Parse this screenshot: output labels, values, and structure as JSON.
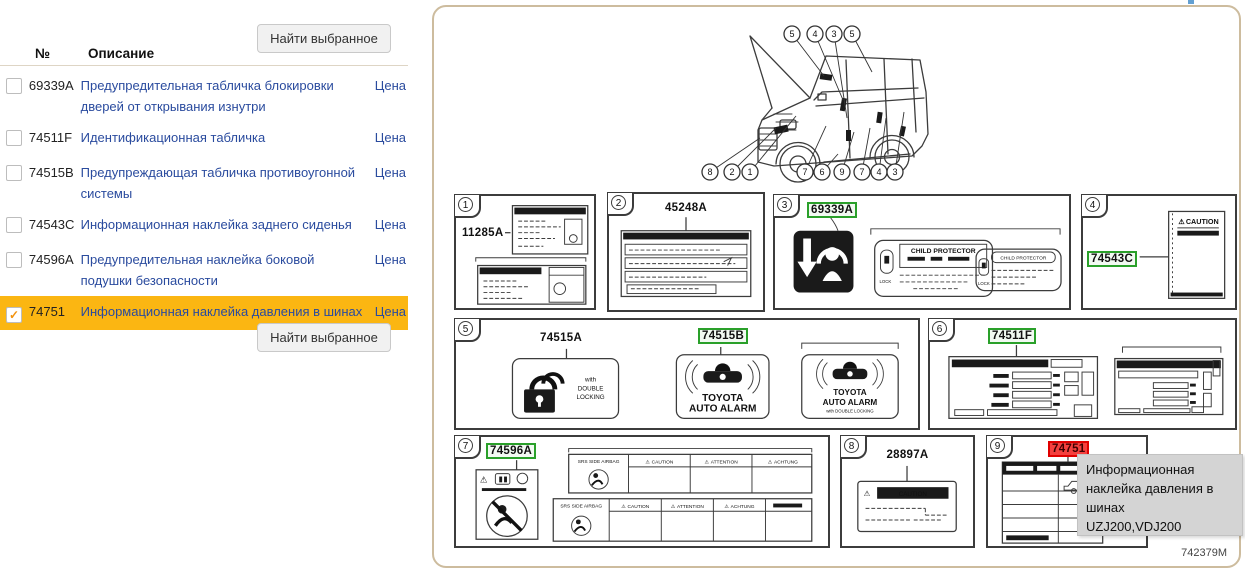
{
  "icons": {
    "check": "✓",
    "warning": "⚠"
  },
  "colors": {
    "highlight_row": "#FBB612",
    "link": "#2A4B9E",
    "panel_border": "#CDBC9E",
    "green_part": "#2AA02A",
    "red_part": "#E00000",
    "tooltip_bg": "#D4D4D4"
  },
  "parts_table": {
    "col_no": "№",
    "col_desc": "Описание",
    "find_button": "Найти выбранное",
    "price_label": "Цена",
    "rows": [
      {
        "num": "69339A",
        "desc": "Предупредительная табличка блокировки дверей от открывания изнутри",
        "checked": false,
        "highlighted": false
      },
      {
        "num": "74511F",
        "desc": "Идентификационная табличка",
        "checked": false,
        "highlighted": false
      },
      {
        "num": "74515B",
        "desc": "Предупреждающая табличка противоугонной системы",
        "checked": false,
        "highlighted": false
      },
      {
        "num": "74543C",
        "desc": "Информационная наклейка заднего сиденья",
        "checked": false,
        "highlighted": false
      },
      {
        "num": "74596A",
        "desc": "Предупредительная наклейка боковой подушки безопасности",
        "checked": false,
        "highlighted": false
      },
      {
        "num": "74751",
        "desc": "Информационная наклейка давления в шинах",
        "checked": true,
        "highlighted": true
      }
    ]
  },
  "diagram": {
    "code": "742379M",
    "car_callouts": {
      "top": [
        "5",
        "4",
        "3",
        "5"
      ],
      "bottom": [
        "8",
        "2",
        "1",
        "7",
        "6",
        "9",
        "7",
        "4",
        "3"
      ]
    },
    "boxes": {
      "b1": {
        "num": "1",
        "part": "11285A"
      },
      "b2": {
        "num": "2",
        "part": "45248A"
      },
      "b3": {
        "num": "3",
        "part": "69339A",
        "title": "CHILD PROTECTOR",
        "lock": "LOCK"
      },
      "b4": {
        "num": "4",
        "part": "74543C",
        "caution": "CAUTION"
      },
      "b5": {
        "num": "5",
        "part_a": "74515A",
        "part_b": "74515B",
        "alarm1": "TOYOTA",
        "alarm2": "AUTO ALARM",
        "dl1": "with",
        "dl2": "DOUBLE",
        "dl3": "LOCKING",
        "dl_small": "with DOUBLE LOCKING"
      },
      "b6": {
        "num": "6",
        "part": "74511F"
      },
      "b7": {
        "num": "7",
        "part": "74596A",
        "strip": "SRS SIDE AIRBAG",
        "col1": "CAUTION",
        "col2": "ATTENTION",
        "col3": "ACHTUNG"
      },
      "b8": {
        "num": "8",
        "part": "28897A",
        "caution": "CAUTION"
      },
      "b9": {
        "num": "9",
        "part": "74751"
      }
    },
    "tooltip": {
      "text": "Информационная наклейка давления в шинах",
      "models": "UZJ200,VDJ200"
    }
  }
}
